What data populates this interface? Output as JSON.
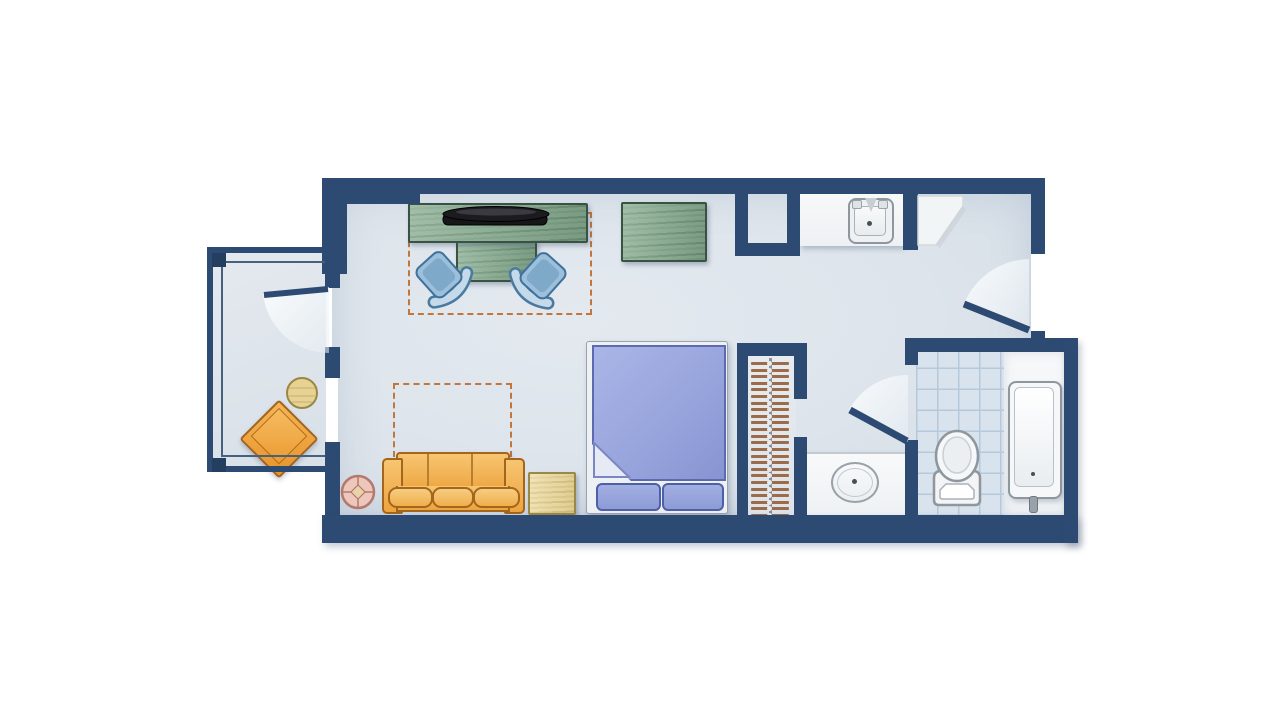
{
  "title": "studio-hotel-room-floor-plan",
  "colors": {
    "wall": "#2d4b72",
    "floor": "#dde4eb",
    "balcony_floor": "#e0e6ec",
    "tile_floor": "#d8e3ed",
    "tile_line": "#b6c9da",
    "fixture_white": "#f4f6f7",
    "wood_green": "#82a88b",
    "wood_tan": "#ead898",
    "sofa_orange": "#f2b25c",
    "bed_blue": "#98a5dd",
    "chair_blue": "#a9c8e1",
    "fold_out_dashed": "#c2763b",
    "hanger_brown": "#9c6b4a",
    "side_table_pink": "#edc6bc",
    "balcony_chair_orange": "#f0a843"
  },
  "rooms": [
    {
      "name": "main-room"
    },
    {
      "name": "balcony"
    },
    {
      "name": "kitchenette"
    },
    {
      "name": "closet"
    },
    {
      "name": "vanity-nook"
    },
    {
      "name": "bathroom"
    },
    {
      "name": "entry"
    }
  ],
  "furniture": [
    {
      "name": "tv-console"
    },
    {
      "name": "flat-screen-tv"
    },
    {
      "name": "table-pedestal"
    },
    {
      "name": "chair-left"
    },
    {
      "name": "chair-right"
    },
    {
      "name": "dresser"
    },
    {
      "name": "bed"
    },
    {
      "name": "bed-pillow",
      "count": 2
    },
    {
      "name": "sleeper-sofa"
    },
    {
      "name": "fold-out-bed-outline",
      "count": 2
    },
    {
      "name": "end-table"
    },
    {
      "name": "round-side-table"
    },
    {
      "name": "balcony-chair"
    },
    {
      "name": "balcony-round-table"
    },
    {
      "name": "kitchen-sink"
    },
    {
      "name": "vanity-sink"
    },
    {
      "name": "toilet"
    },
    {
      "name": "bathtub"
    },
    {
      "name": "closet-hanger-rod"
    }
  ],
  "closet": {
    "hanger_count": 24
  },
  "doors": [
    {
      "name": "entry-door"
    },
    {
      "name": "bathroom-door"
    },
    {
      "name": "balcony-door"
    }
  ],
  "windows": [
    {
      "name": "balcony-window"
    }
  ]
}
